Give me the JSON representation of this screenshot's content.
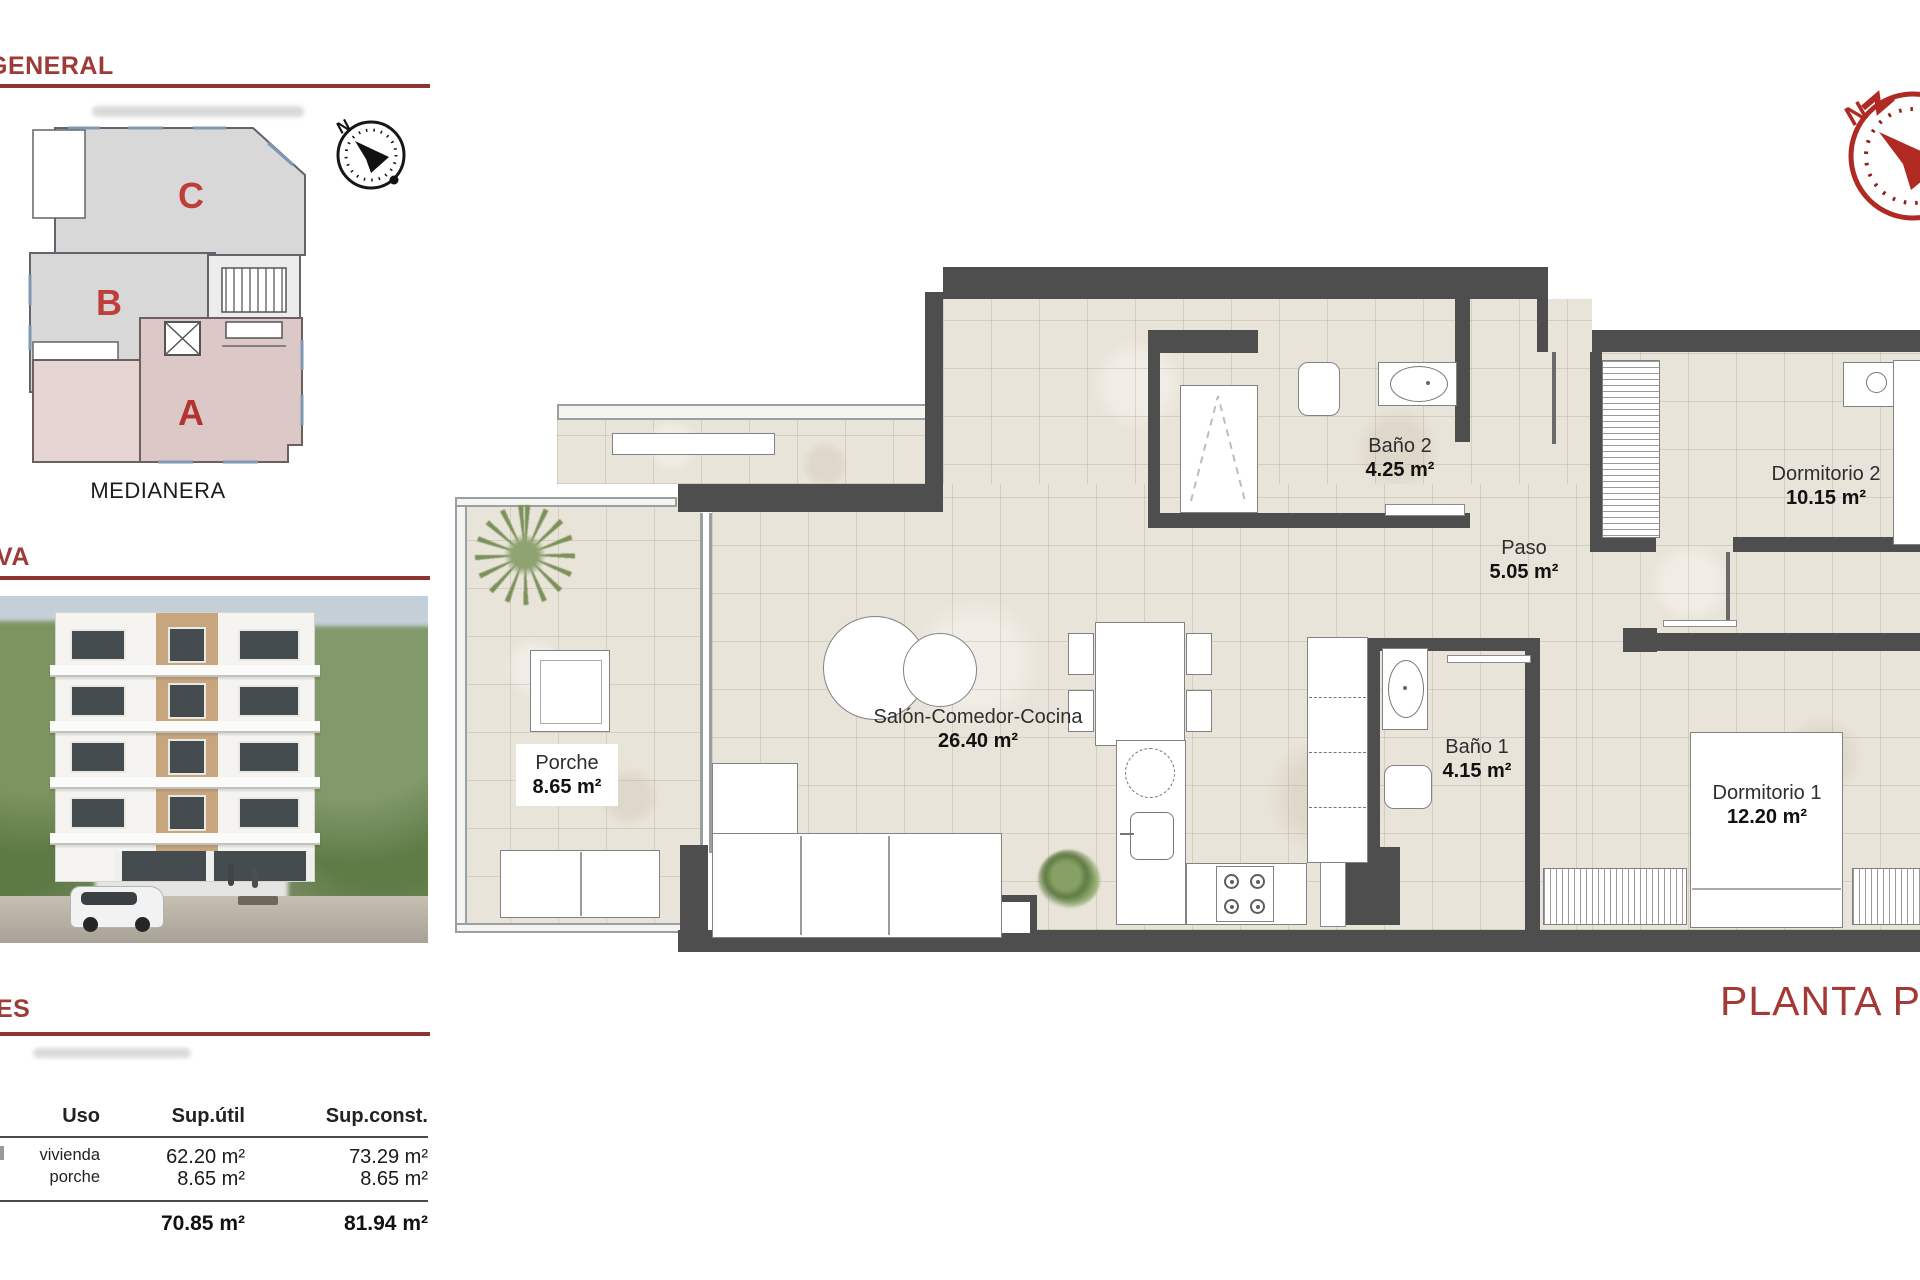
{
  "colors": {
    "accent_line": "#8d3430",
    "header_text": "#9c3b38",
    "plan_title_color": "#a33a36",
    "wall": "#4e4e4e",
    "block_a_fill": "#dcc8c6",
    "block_letter": "#bf3e3a",
    "floor": "#e9e4d9"
  },
  "left_panels": {
    "site_plan": {
      "header": "GENERAL",
      "caption": "MEDIANERA",
      "blocks": [
        {
          "label": "C"
        },
        {
          "label": "B"
        },
        {
          "label": "A"
        }
      ],
      "compass_label": "N"
    },
    "render": {
      "header": "VA"
    },
    "areas_table": {
      "header": "ES",
      "columns": [
        "Uso",
        "Sup.útil",
        "Sup.const."
      ],
      "rows": [
        {
          "label": "vivienda",
          "util": "62.20 m²",
          "cons": "73.29 m²"
        },
        {
          "label": "porche",
          "util": "8.65 m²",
          "cons": "8.65 m²"
        }
      ],
      "totals": {
        "util": "70.85 m²",
        "cons": "81.94 m²"
      }
    }
  },
  "floor_plan": {
    "title": "PLANTA PRIMERA",
    "compass_label": "N",
    "rooms": [
      {
        "name": "Baño 2",
        "area": "4.25 m²"
      },
      {
        "name": "Paso",
        "area": "5.05 m²"
      },
      {
        "name": "Dormitorio 2",
        "area": "10.15 m²"
      },
      {
        "name": "Salón-Comedor-Cocina",
        "area": "26.40 m²"
      },
      {
        "name": "Baño 1",
        "area": "4.15 m²"
      },
      {
        "name": "Dormitorio 1",
        "area": "12.20 m²"
      },
      {
        "name": "Porche",
        "area": "8.65 m²"
      }
    ]
  }
}
